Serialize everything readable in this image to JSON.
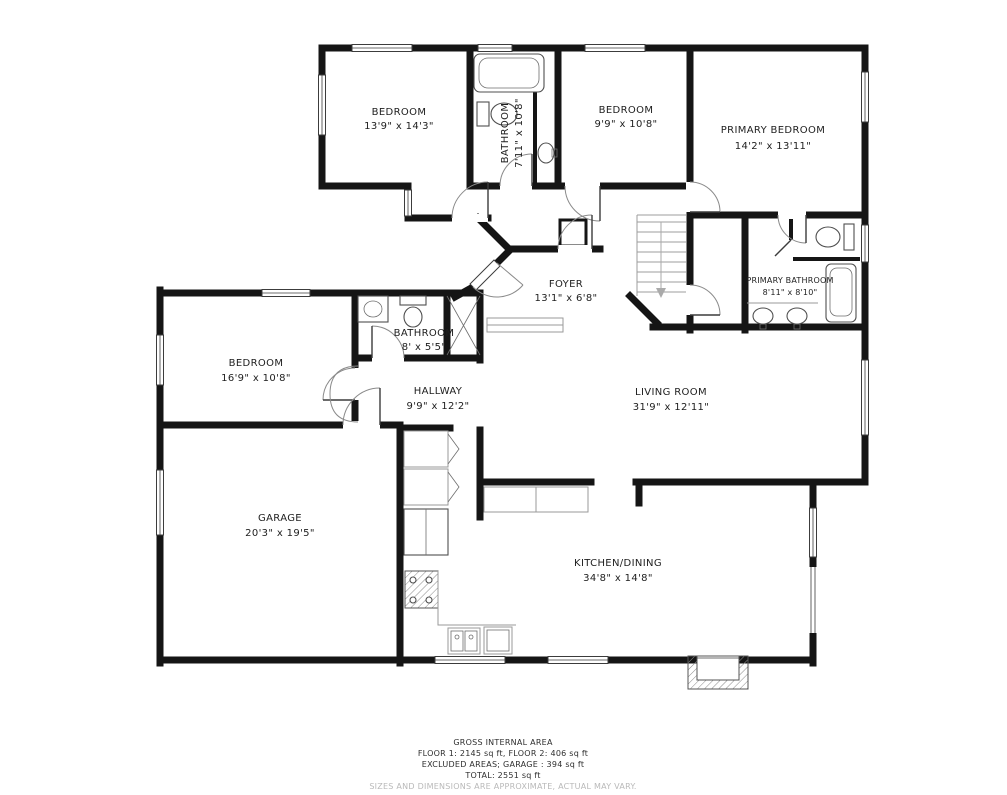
{
  "plan": {
    "rooms": [
      {
        "name": "BEDROOM",
        "dims": "13'9\" x 14'3\""
      },
      {
        "name": "BATHROOM",
        "dims": "7'11\" x 10'8\""
      },
      {
        "name": "BEDROOM",
        "dims": "9'9\" x 10'8\""
      },
      {
        "name": "PRIMARY BEDROOM",
        "dims": "14'2\" x 13'11\""
      },
      {
        "name": "FOYER",
        "dims": "13'1\" x 6'8\""
      },
      {
        "name": "PRIMARY BATHROOM",
        "dims": "8'11\" x 8'10\""
      },
      {
        "name": "BEDROOM",
        "dims": "16'9\" x 10'8\""
      },
      {
        "name": "BATHROOM",
        "dims": "8' x 5'5\""
      },
      {
        "name": "HALLWAY",
        "dims": "9'9\" x 12'2\""
      },
      {
        "name": "LIVING ROOM",
        "dims": "31'9\" x 12'11\""
      },
      {
        "name": "GARAGE",
        "dims": "20'3\" x 19'5\""
      },
      {
        "name": "KITCHEN/DINING",
        "dims": "34'8\" x 14'8\""
      }
    ],
    "footer": {
      "title": "GROSS INTERNAL AREA",
      "line1": "FLOOR 1: 2145 sq ft, FLOOR 2: 406 sq ft",
      "line2": "EXCLUDED AREAS; GARAGE : 394 sq ft",
      "line3": "TOTAL: 2551 sq ft",
      "disclaimer": "SIZES AND DIMENSIONS ARE APPROXIMATE, ACTUAL MAY VARY."
    },
    "colors": {
      "wall": "#151515",
      "background": "#ffffff",
      "disclaimer": "#b9b9b9"
    }
  }
}
